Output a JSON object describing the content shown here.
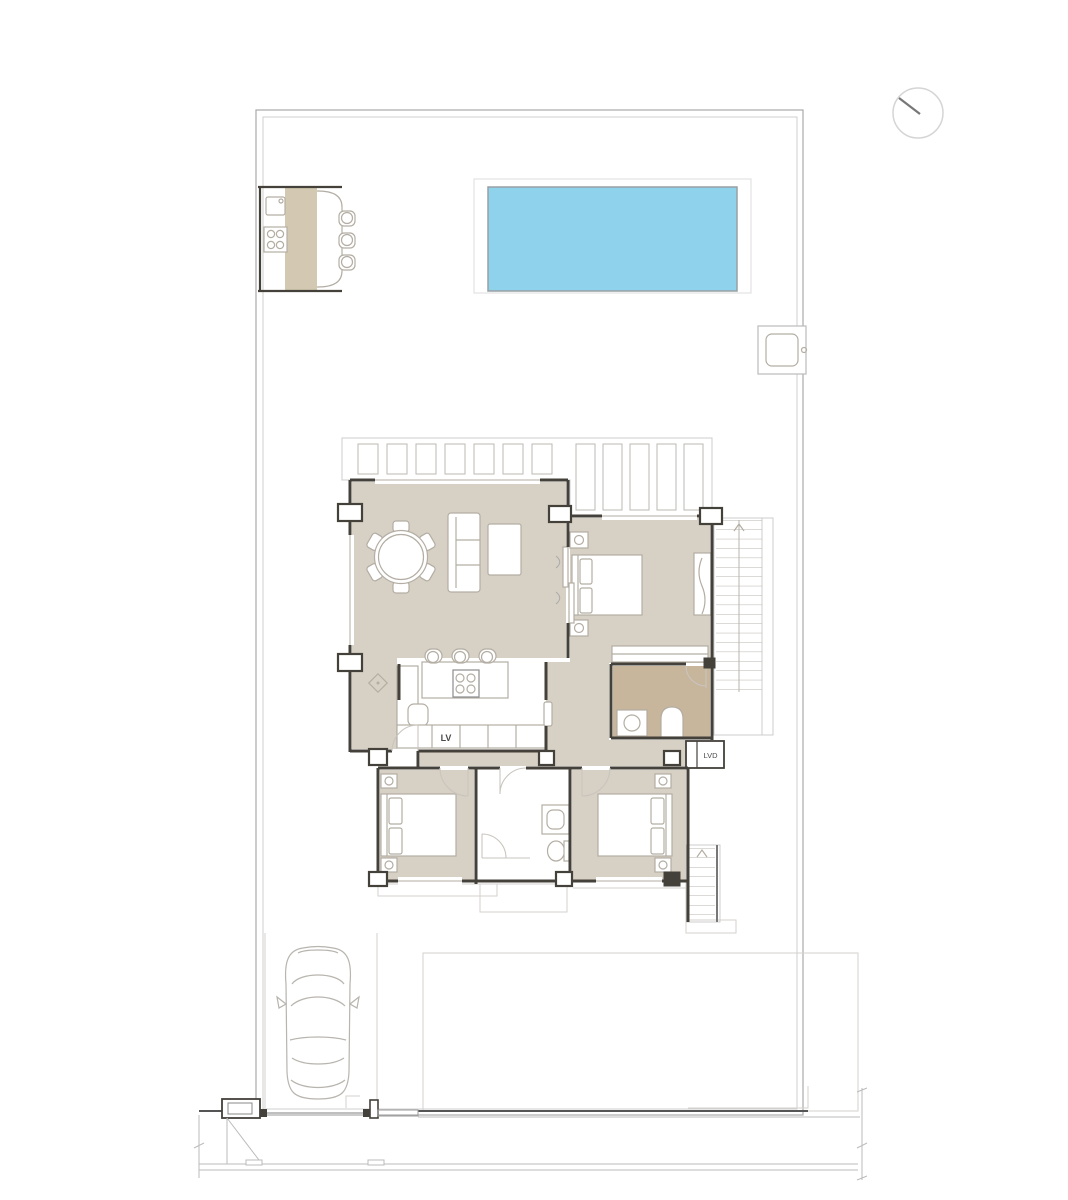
{
  "plan": {
    "labels": {
      "dishwasher": "LV",
      "washer": "LVD"
    },
    "colors": {
      "floor": "#d7d0c4",
      "bath_floor": "#c7b59c",
      "counter_strip": "#d3c9b2",
      "pool_water": "#8ed2ec",
      "wall": "#44403a"
    }
  }
}
